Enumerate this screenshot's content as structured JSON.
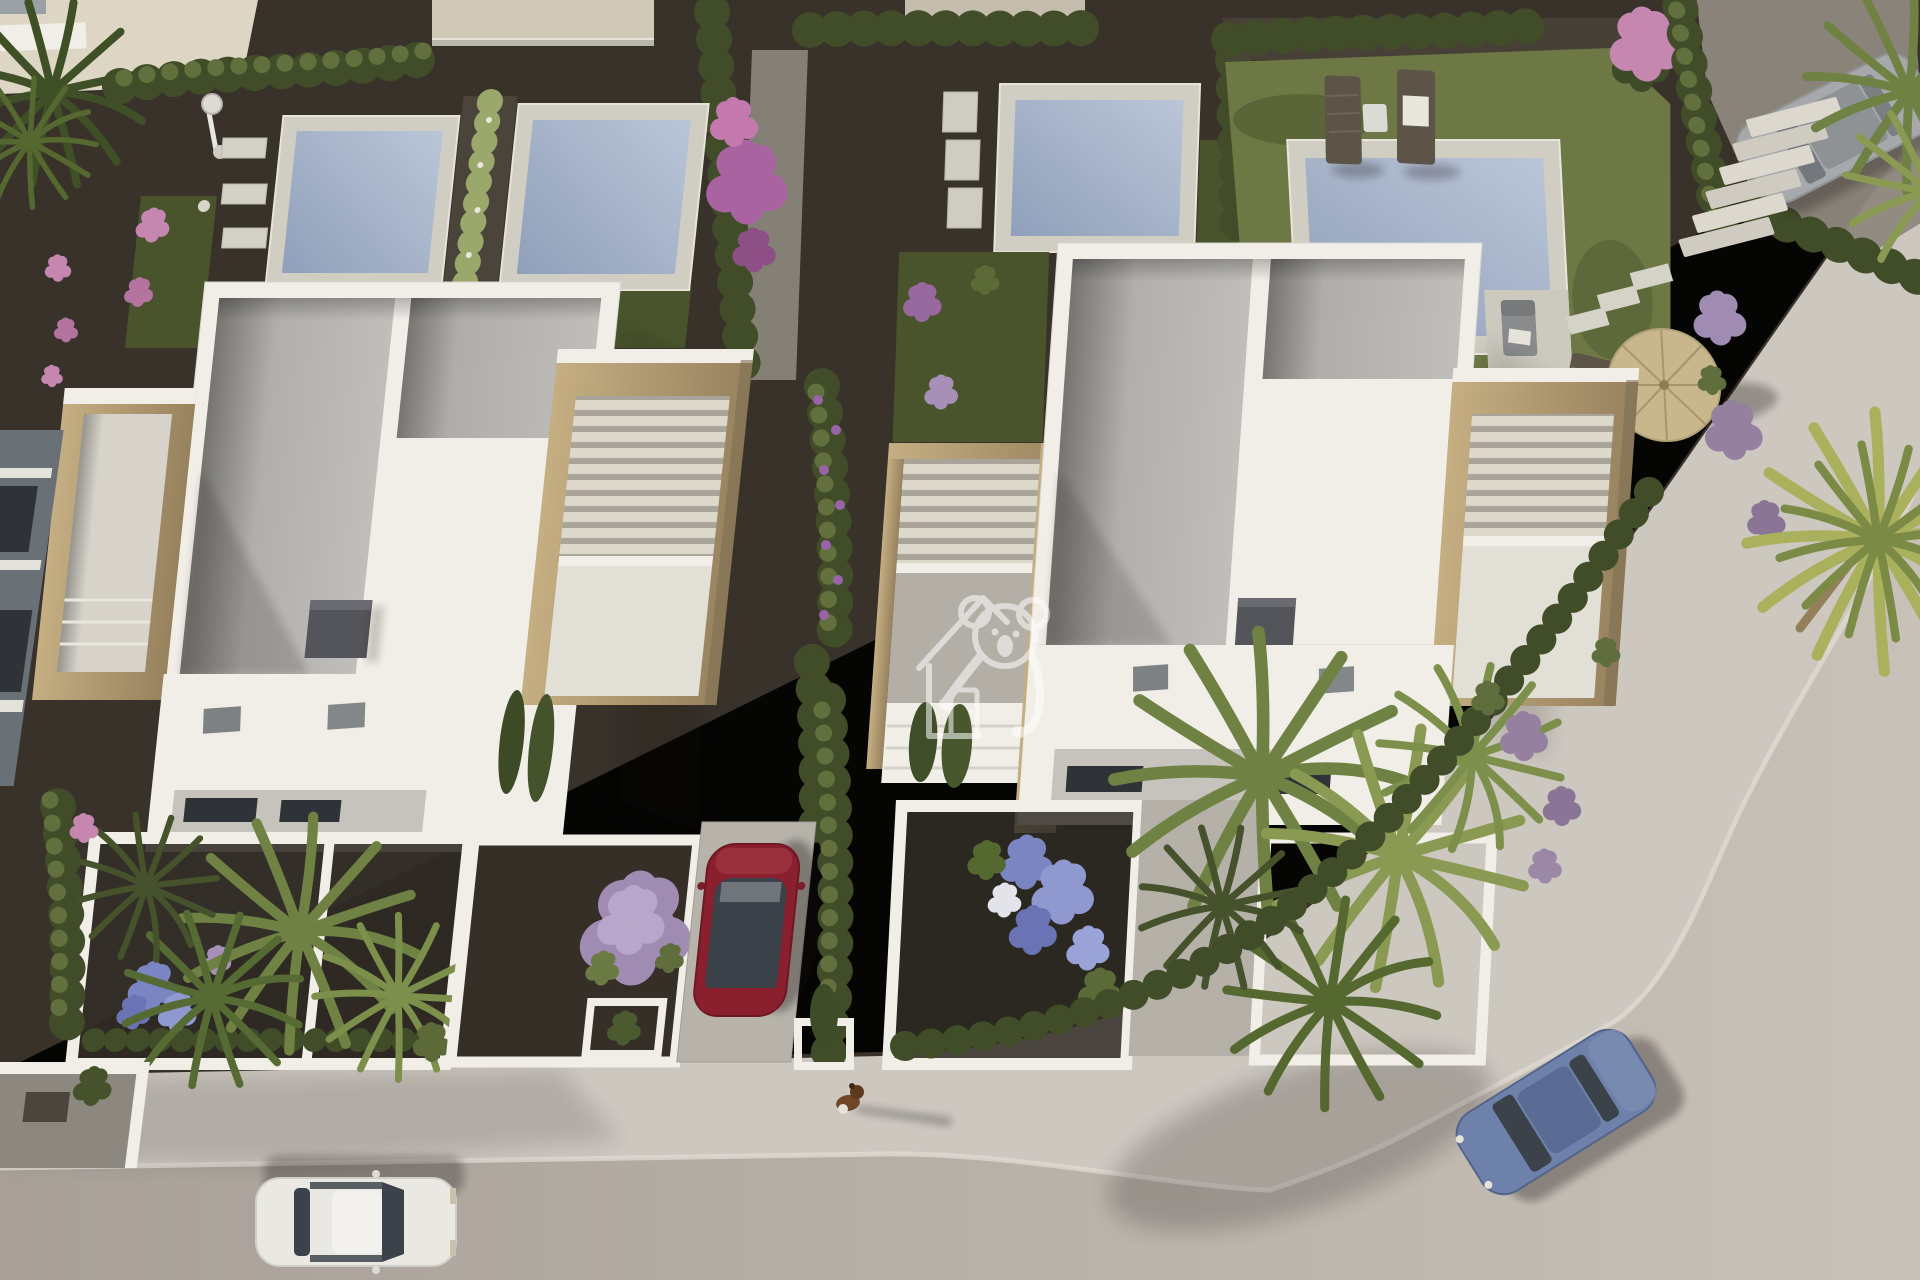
{
  "image": {
    "type": "3d-aerial-architectural-render",
    "description": "Bird's-eye 3D render of a modern white villa development with private pools, gravel gardens, palm trees, parked cars, a small dog on the sidewalk and a curved road at the bottom and right",
    "lighting": "low warm sun from the left casting long shadows to the right",
    "visible_text": "none"
  },
  "watermark": {
    "name": "koala-house-logo",
    "description": "semi-transparent white outline of a koala leaning over a pitched-roof house with a door",
    "position": "center of image, on the right villa's entrance pergola",
    "opacity": 0.55
  },
  "scene": {
    "villas": [
      {
        "name": "left-villa",
        "features": [
          "white parapet walls",
          "two grey gravel flat-roof sections",
          "dark chimney",
          "stone-clad roof terrace left",
          "stone and slatted pergola terrace right",
          "lower white roof with two skylights",
          "rear terrace with glass doors"
        ]
      },
      {
        "name": "right-villa",
        "features": [
          "white parapet walls",
          "two grey gravel flat-roof sections",
          "dark chimney",
          "stone entrance pergola with slats (watermarked)",
          "stone and slatted pergola terrace right",
          "lower white roof with two skylights"
        ]
      }
    ],
    "pools": {
      "count": 4,
      "description": "rectangular blue-grey pools with pale stone surrounds behind the villas, with white stepping pads"
    },
    "vehicles": [
      {
        "name": "red-car",
        "color": "dark red",
        "location": "center driveway, parked facing the street"
      },
      {
        "name": "white-car",
        "color": "white",
        "location": "road, bottom left, driving right"
      },
      {
        "name": "blue-car",
        "color": "steel blue",
        "location": "road, bottom right, on the curve"
      },
      {
        "name": "silver-car",
        "color": "silver",
        "location": "driveway, top right, under palm fronds"
      }
    ],
    "animals": [
      {
        "name": "small-dog",
        "location": "sidewalk, bottom center, casting a long shadow"
      }
    ],
    "furniture": [
      "two dark sun loungers with towel by the top-right pool",
      "white side table",
      "grey armchair on pool terrace",
      "straw parasol with wooden deck chair",
      "outdoor shower top left",
      "white garden bench top left"
    ],
    "landscaping": [
      "clipped hedgerows",
      "fan palms",
      "banana plant",
      "purple and pink flowering shrubs",
      "lilac pompon shrub",
      "blue hydrangeas",
      "dark gravel beds",
      "lawns",
      "stone steps and stepping pads top right"
    ],
    "infrastructure": [
      "curved road with pale sidewalk and white curbs",
      "white courtyard walls of front gardens"
    ]
  },
  "colors": {
    "gravel_dark": "#38322a",
    "gravel_mid": "#4b443a",
    "path_light": "#8e887d",
    "road_light": "#c7c1b8",
    "road_dark": "#a8a098",
    "sidewalk": "#ccc7bf",
    "curb_white": "#eae7e0",
    "grass_light": "#6d7845",
    "grass_dark": "#49532c",
    "hedge_dark": "#414d29",
    "hedge_light": "#61703c",
    "pool_border": "#d0cdc3",
    "pool_water": "#90a0ba",
    "pool_water_light": "#bac5d7",
    "villa_white": "#f1eee7",
    "roof_terrace": "#cecbc3",
    "roof_gray_dark": "#a9a7a3",
    "roof_gray_light": "#c0beba",
    "stone_light": "#c5ae82",
    "stone_dark": "#97825e",
    "slat_light": "#ddd8cc",
    "slat_shadow": "#a9a49a",
    "chimney_gray": "#54555a",
    "window_dark": "#2f3236",
    "car_red": "#8a1f2e",
    "car_white": "#e9e8e3",
    "car_blue": "#6d81aa",
    "car_silver": "#a6a8ab",
    "glass_dark": "#3c4249",
    "palm_green": "#6f8243",
    "palm_dark": "#4d5c2f",
    "palm_yellow": "#a9b15c",
    "flower_purple": "#97699f",
    "flower_lilac": "#a78fb8",
    "flower_pink": "#c586b0",
    "flower_blue": "#7b85c2",
    "wood_dark": "#5c5447",
    "straw": "#c8b78d",
    "pavement_cream": "#ddd6c4",
    "neighbor_gray": "#697076",
    "watermark_white": "#ffffff"
  }
}
